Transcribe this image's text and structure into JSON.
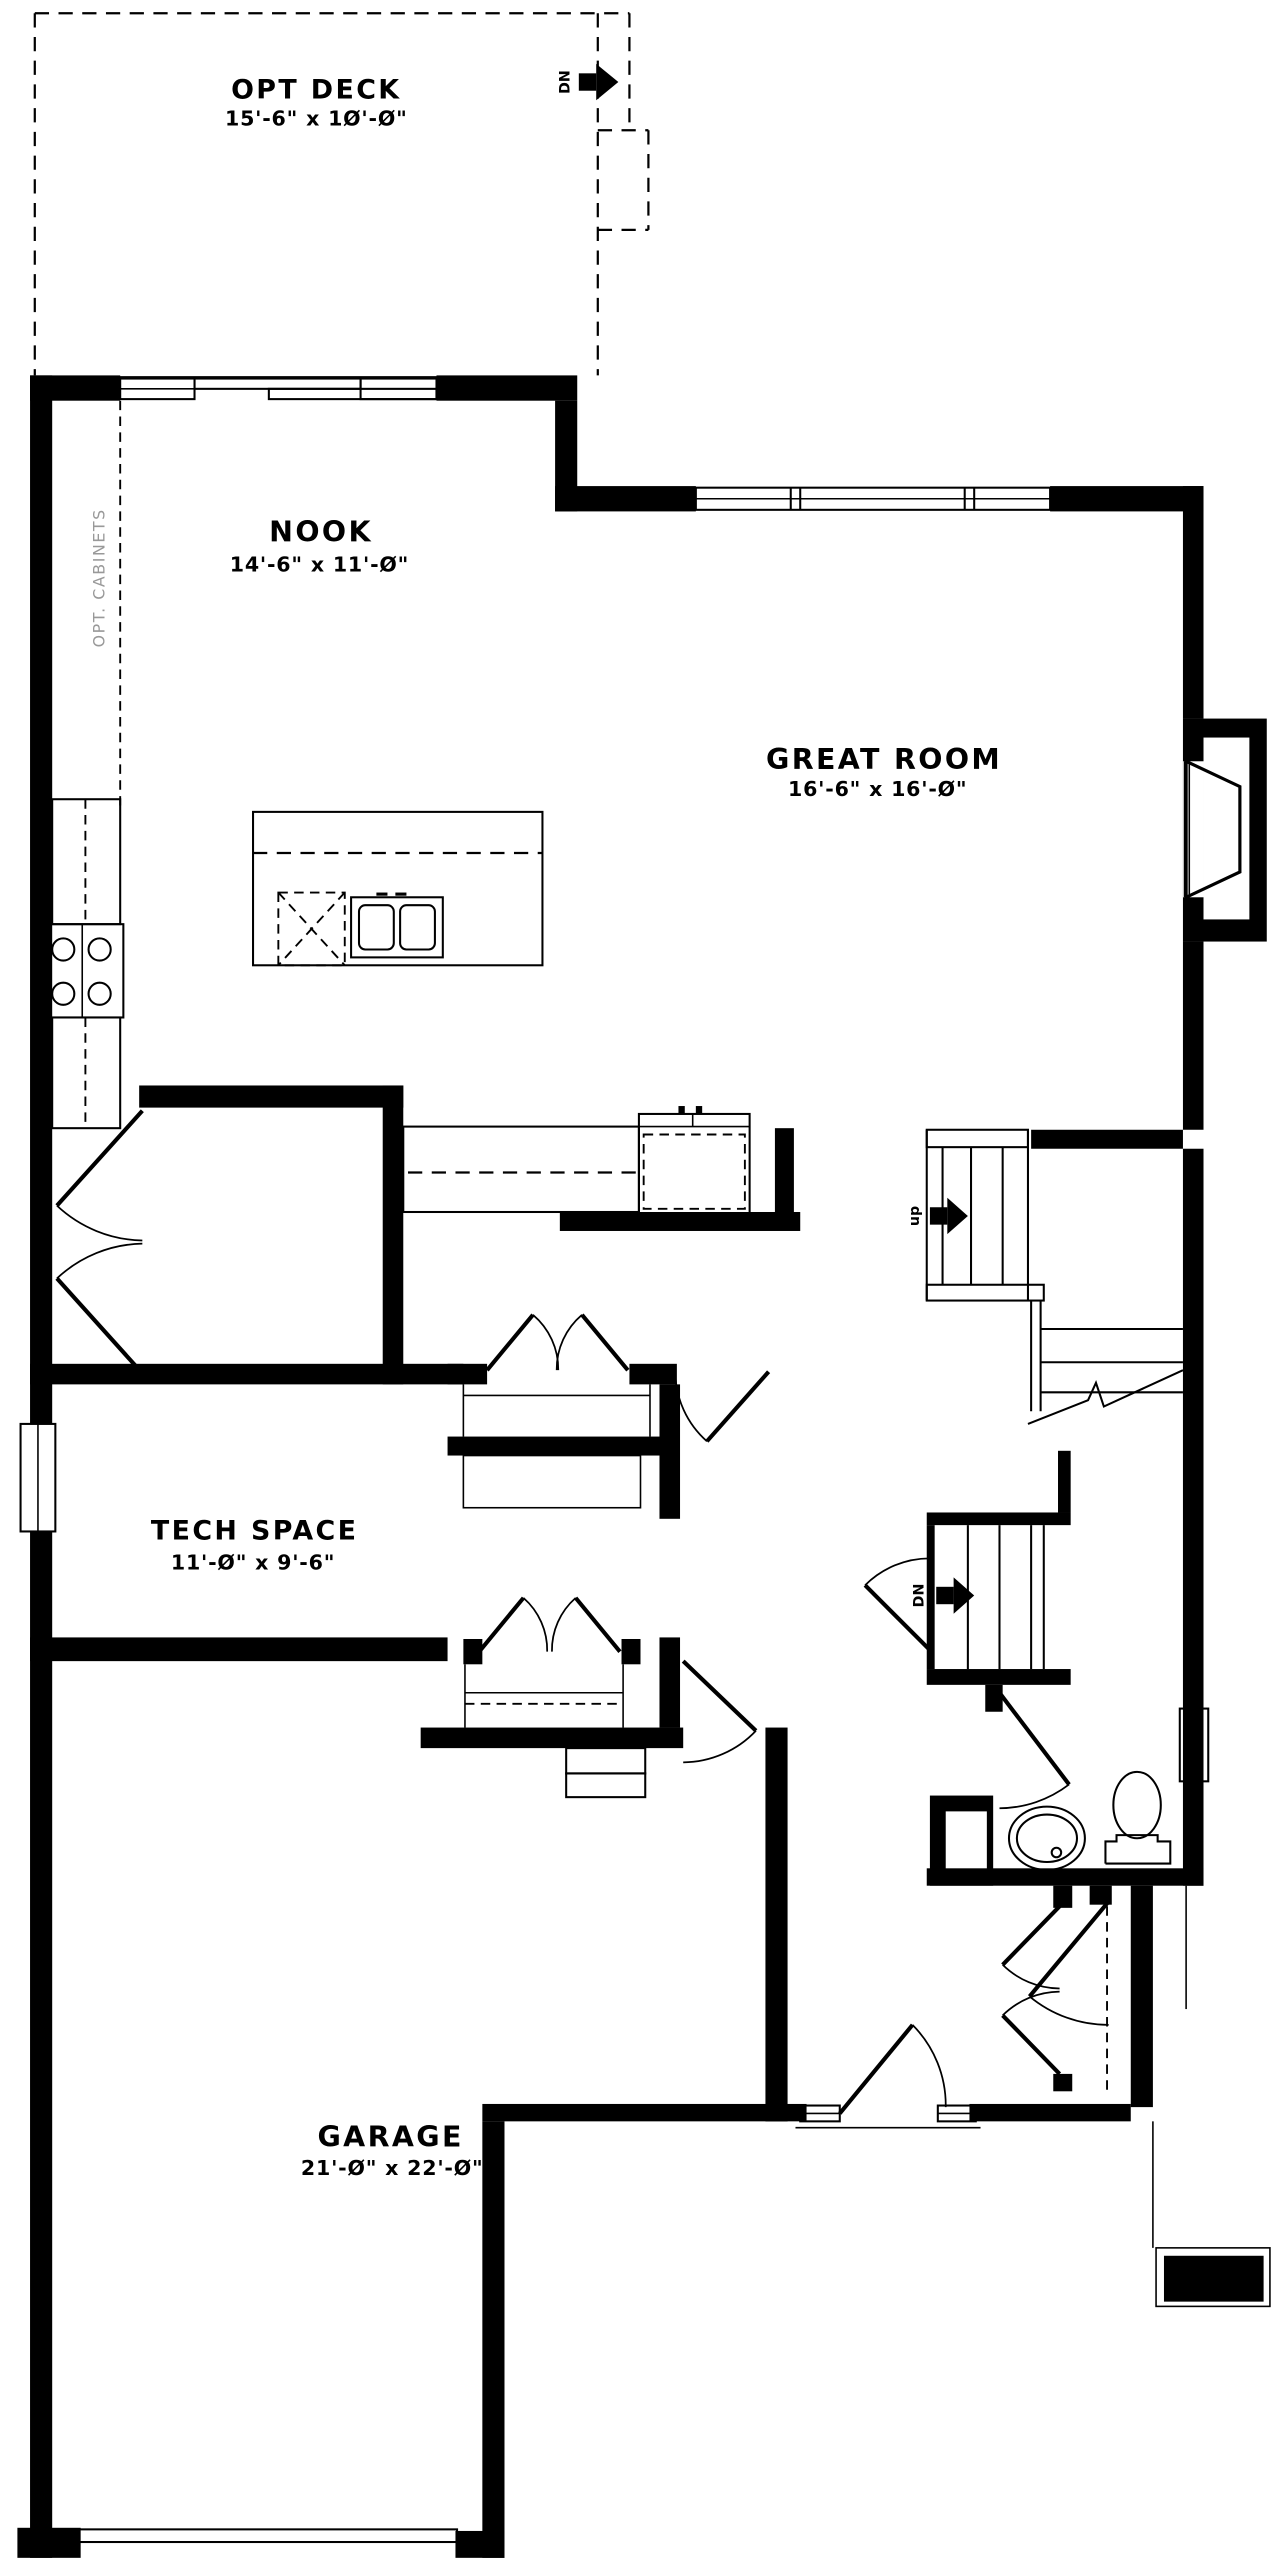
{
  "plan": {
    "title": "Main floor plan",
    "colors": {
      "walls": "#000000",
      "background": "#ffffff",
      "muted_text": "#999999"
    },
    "rooms": [
      {
        "id": "opt-deck",
        "name": "OPT DECK",
        "dims": "15'-6\" x 1Ø'-Ø\""
      },
      {
        "id": "nook",
        "name": "NOOK",
        "dims": "14'-6\" x 11'-Ø\""
      },
      {
        "id": "great-room",
        "name": "GREAT ROOM",
        "dims": "16'-6\" x 16'-Ø\""
      },
      {
        "id": "tech-space",
        "name": "TECH SPACE",
        "dims": "11'-Ø\" x 9'-6\""
      },
      {
        "id": "garage",
        "name": "GARAGE",
        "dims": "21'-Ø\" x 22'-Ø\""
      }
    ],
    "annotations": {
      "opt_cabinets": "OPT. CABINETS",
      "stair_up": "up",
      "stair_dn": "DN",
      "deck_dn": "DN"
    },
    "fixtures": [
      "range-cooktop",
      "kitchen-island",
      "dishwasher",
      "double-sink",
      "refrigerator",
      "counter",
      "bath-sink",
      "toilet",
      "fireplace"
    ]
  }
}
